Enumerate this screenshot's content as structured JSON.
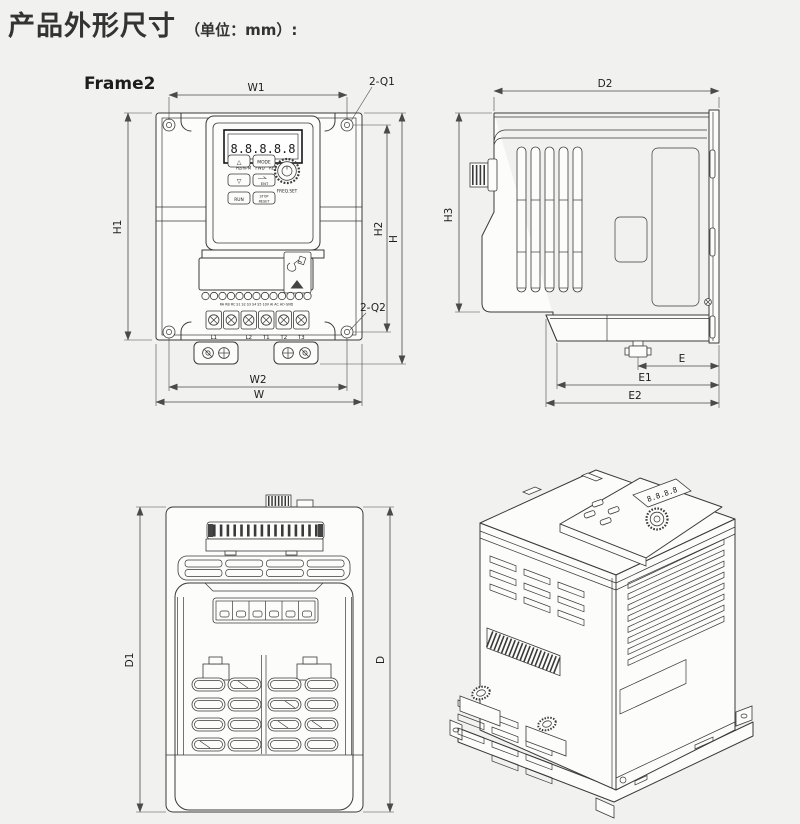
{
  "page": {
    "title": "产品外形尺寸",
    "unit_note": "（单位：mm）:",
    "frame_label": "Frame2"
  },
  "colors": {
    "background": "#f1f1ef",
    "line": "#3a3a3a",
    "dim_line": "#4a4a4a",
    "text": "#1d1d1d",
    "body_fill": "#fcfcfb"
  },
  "keypad": {
    "display": "8.8.8.8.8",
    "indicators": "Hz/RPM FWD REV RUN",
    "btn_up": "△",
    "btn_mode": "MODE",
    "btn_down": "▽",
    "btn_ent": "ENT",
    "btn_run": "RUN",
    "btn_stop_line1": "STOP",
    "btn_stop_line2": "RESET",
    "knob_label": "FREQ.SET"
  },
  "iso": {
    "display": "8.8.8.8"
  },
  "terminals": {
    "control_labels": "RA RB RC S1 S2 S3 S4 S5 10V AI AC AO GND",
    "power": [
      "L1",
      "L2",
      "T1",
      "T2",
      "T3"
    ]
  },
  "dims": {
    "w1": "W1",
    "q1": "2-Q1",
    "h1": "H1",
    "h2": "H2",
    "h": "H",
    "q2": "2-Q2",
    "w2": "W2",
    "w": "W",
    "d2": "D2",
    "h3": "H3",
    "e": "E",
    "e1": "E1",
    "e2": "E2",
    "d1": "D1",
    "d": "D"
  }
}
